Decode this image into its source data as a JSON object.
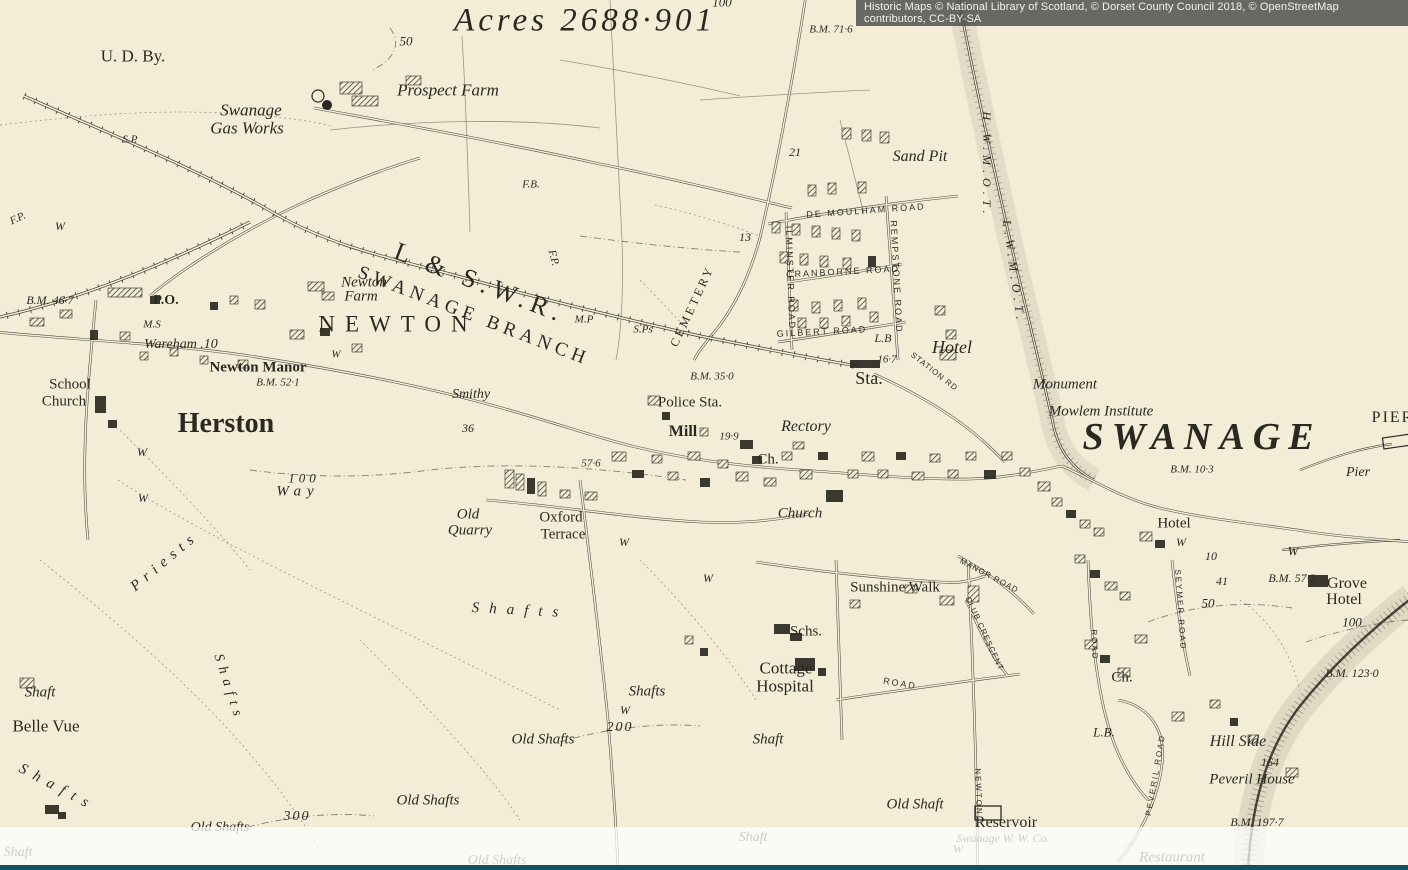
{
  "attribution": {
    "text": "Historic Maps © National Library of Scotland, © Dorset County Council 2018, © OpenStreetMap contributors, CC-BY-SA"
  },
  "colors": {
    "paper": "#f3edd7",
    "ink": "#2b2822",
    "attribution_bg": "#4a4a4a",
    "footer_bar": "#14505f"
  },
  "map": {
    "place": "Swanage",
    "labels": [
      {
        "t": "Acres 2688·901",
        "x": 585,
        "y": 21,
        "fs": 33,
        "cls": "it",
        "ls": 4
      },
      {
        "t": "100",
        "x": 722,
        "y": 2,
        "fs": 13,
        "cls": "it"
      },
      {
        "t": "B.M. 71·6",
        "x": 831,
        "y": 30,
        "fs": 11,
        "cls": "it"
      },
      {
        "t": "50",
        "x": 406,
        "y": 41,
        "fs": 13,
        "cls": "it"
      },
      {
        "t": "U. D. By.",
        "x": 133,
        "y": 56,
        "fs": 17,
        "cls": "rm"
      },
      {
        "t": "Prospect Farm",
        "x": 448,
        "y": 90,
        "fs": 17,
        "cls": "it"
      },
      {
        "t": "Swanage",
        "x": 251,
        "y": 110,
        "fs": 17,
        "cls": "it"
      },
      {
        "t": "Gas Works",
        "x": 247,
        "y": 128,
        "fs": 17,
        "cls": "it"
      },
      {
        "t": "S.P",
        "x": 130,
        "y": 140,
        "fs": 11,
        "cls": "it"
      },
      {
        "t": "21",
        "x": 795,
        "y": 152,
        "fs": 12,
        "cls": "it"
      },
      {
        "t": "Sand Pit",
        "x": 920,
        "y": 157,
        "fs": 16,
        "cls": "it"
      },
      {
        "t": "H.W.M.O.T.",
        "x": 987,
        "y": 165,
        "fs": 12,
        "cls": "it",
        "rot": 90,
        "ls": 5
      },
      {
        "t": "L.W.M.O.T.",
        "x": 1014,
        "y": 272,
        "fs": 12,
        "cls": "it",
        "rot": 82,
        "ls": 5
      },
      {
        "t": "F.B.",
        "x": 531,
        "y": 185,
        "fs": 11,
        "cls": "it"
      },
      {
        "t": "F.P.",
        "x": 18,
        "y": 219,
        "fs": 11,
        "cls": "it",
        "rot": -25
      },
      {
        "t": "W",
        "x": 60,
        "y": 226,
        "fs": 12,
        "cls": "it"
      },
      {
        "t": "13",
        "x": 745,
        "y": 237,
        "fs": 12,
        "cls": "it"
      },
      {
        "t": "F.P.",
        "x": 553,
        "y": 258,
        "fs": 11,
        "cls": "it",
        "rot": 75
      },
      {
        "t": "DE MOULHAM ROAD",
        "x": 866,
        "y": 211,
        "fs": 9,
        "cls": "sans",
        "ls": 2,
        "rot": -4
      },
      {
        "t": "CRANBORNE ROAD",
        "x": 843,
        "y": 272,
        "fs": 9,
        "cls": "sans",
        "ls": 2,
        "rot": -3
      },
      {
        "t": "GILBERT ROAD",
        "x": 822,
        "y": 332,
        "fs": 9,
        "cls": "sans",
        "ls": 2,
        "rot": -3
      },
      {
        "t": "REMPSTONE ROAD",
        "x": 896,
        "y": 277,
        "fs": 9,
        "cls": "sans",
        "ls": 2,
        "rot": 87
      },
      {
        "t": "ILMINSTER ROAD",
        "x": 790,
        "y": 278,
        "fs": 9,
        "cls": "sans",
        "ls": 2,
        "rot": 88
      },
      {
        "t": "L & S.W.R.",
        "x": 480,
        "y": 283,
        "fs": 26,
        "cls": "rm",
        "ls": 6,
        "rot": 21
      },
      {
        "t": "SWANAGE BRANCH",
        "x": 474,
        "y": 316,
        "fs": 19,
        "cls": "rm",
        "ls": 5,
        "rot": 21
      },
      {
        "t": "B.M. 46·7",
        "x": 50,
        "y": 300,
        "fs": 12,
        "cls": "it"
      },
      {
        "t": "P.O.",
        "x": 166,
        "y": 301,
        "fs": 14,
        "cls": "rm bold"
      },
      {
        "t": "Newton",
        "x": 364,
        "y": 283,
        "fs": 15,
        "cls": "it"
      },
      {
        "t": "Farm",
        "x": 361,
        "y": 297,
        "fs": 15,
        "cls": "it"
      },
      {
        "t": "NEWTON",
        "x": 398,
        "y": 324,
        "fs": 23,
        "cls": "rm",
        "ls": 10
      },
      {
        "t": "M.P",
        "x": 584,
        "y": 320,
        "fs": 11,
        "cls": "it"
      },
      {
        "t": "S.Ps",
        "x": 643,
        "y": 330,
        "fs": 11,
        "cls": "it"
      },
      {
        "t": "CEMETERY",
        "x": 692,
        "y": 306,
        "fs": 12,
        "cls": "rm",
        "ls": 3,
        "rot": -65
      },
      {
        "t": "L.B",
        "x": 883,
        "y": 338,
        "fs": 12,
        "cls": "it"
      },
      {
        "t": "Hotel",
        "x": 952,
        "y": 347,
        "fs": 18,
        "cls": "it"
      },
      {
        "t": "16·7",
        "x": 887,
        "y": 360,
        "fs": 11,
        "cls": "it"
      },
      {
        "t": "Sta.",
        "x": 869,
        "y": 378,
        "fs": 18,
        "cls": "rm"
      },
      {
        "t": "STATION RD",
        "x": 934,
        "y": 372,
        "fs": 8,
        "cls": "sans",
        "ls": 1,
        "rot": 38
      },
      {
        "t": "M.S",
        "x": 152,
        "y": 325,
        "fs": 11,
        "cls": "it"
      },
      {
        "t": "Wareham .10",
        "x": 181,
        "y": 345,
        "fs": 14,
        "cls": "it"
      },
      {
        "t": "Newton Manor",
        "x": 258,
        "y": 368,
        "fs": 15,
        "cls": "rm bold"
      },
      {
        "t": "B.M. 52·1",
        "x": 278,
        "y": 383,
        "fs": 11,
        "cls": "it"
      },
      {
        "t": "W",
        "x": 336,
        "y": 355,
        "fs": 11,
        "cls": "it"
      },
      {
        "t": "School",
        "x": 70,
        "y": 385,
        "fs": 15,
        "cls": "rm"
      },
      {
        "t": "Church",
        "x": 64,
        "y": 402,
        "fs": 15,
        "cls": "rm"
      },
      {
        "t": "Herston",
        "x": 226,
        "y": 424,
        "fs": 28,
        "cls": "rm bold"
      },
      {
        "t": "Smithy",
        "x": 471,
        "y": 395,
        "fs": 14,
        "cls": "it"
      },
      {
        "t": "36",
        "x": 468,
        "y": 428,
        "fs": 12,
        "cls": "it"
      },
      {
        "t": "B.M. 35·0",
        "x": 712,
        "y": 377,
        "fs": 11,
        "cls": "it"
      },
      {
        "t": "Police Sta.",
        "x": 690,
        "y": 403,
        "fs": 15,
        "cls": "rm"
      },
      {
        "t": "Mill",
        "x": 683,
        "y": 432,
        "fs": 16,
        "cls": "rm bold"
      },
      {
        "t": "19·9",
        "x": 729,
        "y": 437,
        "fs": 11,
        "cls": "it"
      },
      {
        "t": "Rectory",
        "x": 806,
        "y": 427,
        "fs": 16,
        "cls": "it"
      },
      {
        "t": "Ch.",
        "x": 768,
        "y": 460,
        "fs": 15,
        "cls": "rm"
      },
      {
        "t": "Monument",
        "x": 1065,
        "y": 385,
        "fs": 15,
        "cls": "it"
      },
      {
        "t": "Mowlem Institute",
        "x": 1101,
        "y": 412,
        "fs": 15,
        "cls": "it"
      },
      {
        "t": "SWANAGE",
        "x": 1202,
        "y": 437,
        "fs": 38,
        "cls": "it bold",
        "ls": 8
      },
      {
        "t": "B.M. 10·3",
        "x": 1192,
        "y": 470,
        "fs": 11,
        "cls": "it"
      },
      {
        "t": "PIER",
        "x": 1393,
        "y": 418,
        "fs": 16,
        "cls": "rm",
        "ls": 2
      },
      {
        "t": "Pier",
        "x": 1358,
        "y": 473,
        "fs": 14,
        "cls": "it"
      },
      {
        "t": "57·6",
        "x": 591,
        "y": 464,
        "fs": 11,
        "cls": "it"
      },
      {
        "t": "100",
        "x": 304,
        "y": 478,
        "fs": 13,
        "cls": "it",
        "ls": 4
      },
      {
        "t": "Way",
        "x": 298,
        "y": 492,
        "fs": 15,
        "cls": "it",
        "ls": 6
      },
      {
        "t": "Priests",
        "x": 165,
        "y": 562,
        "fs": 15,
        "cls": "it",
        "ls": 6,
        "rot": -40
      },
      {
        "t": "Church",
        "x": 800,
        "y": 514,
        "fs": 15,
        "cls": "it"
      },
      {
        "t": "Old",
        "x": 468,
        "y": 515,
        "fs": 15,
        "cls": "it"
      },
      {
        "t": "Quarry",
        "x": 470,
        "y": 531,
        "fs": 15,
        "cls": "it"
      },
      {
        "t": "Oxford",
        "x": 561,
        "y": 518,
        "fs": 15,
        "cls": "rm"
      },
      {
        "t": "Terrace",
        "x": 563,
        "y": 535,
        "fs": 15,
        "cls": "rm"
      },
      {
        "t": "W",
        "x": 624,
        "y": 542,
        "fs": 12,
        "cls": "it"
      },
      {
        "t": "W",
        "x": 708,
        "y": 578,
        "fs": 12,
        "cls": "it"
      },
      {
        "t": "W",
        "x": 142,
        "y": 452,
        "fs": 12,
        "cls": "it"
      },
      {
        "t": "W",
        "x": 143,
        "y": 498,
        "fs": 12,
        "cls": "it"
      },
      {
        "t": "Hotel",
        "x": 1174,
        "y": 524,
        "fs": 15,
        "cls": "rm"
      },
      {
        "t": "W",
        "x": 1181,
        "y": 542,
        "fs": 12,
        "cls": "it"
      },
      {
        "t": "W",
        "x": 1293,
        "y": 551,
        "fs": 13,
        "cls": "it"
      },
      {
        "t": "10",
        "x": 1211,
        "y": 556,
        "fs": 12,
        "cls": "it"
      },
      {
        "t": "41",
        "x": 1222,
        "y": 581,
        "fs": 12,
        "cls": "it"
      },
      {
        "t": "B.M. 57·2",
        "x": 1292,
        "y": 578,
        "fs": 12,
        "cls": "it"
      },
      {
        "t": "Grove",
        "x": 1347,
        "y": 584,
        "fs": 16,
        "cls": "rm"
      },
      {
        "t": "Hotel",
        "x": 1344,
        "y": 600,
        "fs": 16,
        "cls": "rm"
      },
      {
        "t": "50",
        "x": 1208,
        "y": 603,
        "fs": 13,
        "cls": "it"
      },
      {
        "t": "SEYMER ROAD",
        "x": 1180,
        "y": 610,
        "fs": 8,
        "cls": "sans",
        "ls": 2,
        "rot": 86
      },
      {
        "t": "Sunshine Walk",
        "x": 895,
        "y": 588,
        "fs": 15,
        "cls": "rm"
      },
      {
        "t": "MANOR ROAD",
        "x": 989,
        "y": 576,
        "fs": 8,
        "cls": "sans",
        "ls": 1,
        "rot": 28
      },
      {
        "t": "CLUB CRESCENT",
        "x": 984,
        "y": 634,
        "fs": 8,
        "cls": "sans",
        "ls": 1,
        "rot": 65
      },
      {
        "t": "ROAD",
        "x": 1094,
        "y": 645,
        "fs": 8,
        "cls": "sans",
        "ls": 2,
        "rot": 88
      },
      {
        "t": "Schs.",
        "x": 806,
        "y": 632,
        "fs": 15,
        "cls": "rm"
      },
      {
        "t": "Cottage",
        "x": 786,
        "y": 668,
        "fs": 17,
        "cls": "rm"
      },
      {
        "t": "Hospital",
        "x": 785,
        "y": 686,
        "fs": 17,
        "cls": "rm"
      },
      {
        "t": "ROAD",
        "x": 900,
        "y": 684,
        "fs": 9,
        "cls": "sans",
        "ls": 2,
        "rot": 10
      },
      {
        "t": "NEWTON",
        "x": 978,
        "y": 792,
        "fs": 8,
        "cls": "sans",
        "ls": 2,
        "rot": 88
      },
      {
        "t": "PEVERIL ROAD",
        "x": 1156,
        "y": 775,
        "fs": 8,
        "cls": "sans",
        "ls": 2,
        "rot": -80
      },
      {
        "t": "Shafts",
        "x": 520,
        "y": 611,
        "fs": 15,
        "cls": "it",
        "ls": 10,
        "rot": 3
      },
      {
        "t": "Shafts",
        "x": 647,
        "y": 692,
        "fs": 15,
        "cls": "it"
      },
      {
        "t": "W",
        "x": 625,
        "y": 710,
        "fs": 12,
        "cls": "it"
      },
      {
        "t": "200",
        "x": 620,
        "y": 728,
        "fs": 14,
        "cls": "it",
        "ls": 2
      },
      {
        "t": "Old Shafts",
        "x": 543,
        "y": 740,
        "fs": 15,
        "cls": "it"
      },
      {
        "t": "Shaft",
        "x": 768,
        "y": 740,
        "fs": 15,
        "cls": "it"
      },
      {
        "t": "Old Shafts",
        "x": 428,
        "y": 801,
        "fs": 15,
        "cls": "it"
      },
      {
        "t": "300",
        "x": 297,
        "y": 817,
        "fs": 14,
        "cls": "it",
        "ls": 2
      },
      {
        "t": "Old Shafts",
        "x": 220,
        "y": 828,
        "fs": 14,
        "cls": "it"
      },
      {
        "t": "Shaft",
        "x": 40,
        "y": 693,
        "fs": 15,
        "cls": "it"
      },
      {
        "t": "Belle Vue",
        "x": 46,
        "y": 726,
        "fs": 17,
        "cls": "rm"
      },
      {
        "t": "Shafts",
        "x": 57,
        "y": 788,
        "fs": 15,
        "cls": "it",
        "ls": 8,
        "rot": 28
      },
      {
        "t": "Shafts",
        "x": 228,
        "y": 688,
        "fs": 14,
        "cls": "it",
        "ls": 6,
        "rot": 72
      },
      {
        "t": "Old Shaft",
        "x": 915,
        "y": 805,
        "fs": 15,
        "cls": "it"
      },
      {
        "t": "Reservoir",
        "x": 1006,
        "y": 823,
        "fs": 16,
        "cls": "rm"
      },
      {
        "t": "Swanage W. W. Co.",
        "x": 1003,
        "y": 838,
        "fs": 12,
        "cls": "it",
        "op": 0.85
      },
      {
        "t": "W",
        "x": 958,
        "y": 849,
        "fs": 12,
        "cls": "it",
        "op": 0.85
      },
      {
        "t": "Restaurant",
        "x": 1172,
        "y": 858,
        "fs": 15,
        "cls": "it",
        "op": 0.85
      },
      {
        "t": "Ch.",
        "x": 1122,
        "y": 678,
        "fs": 15,
        "cls": "rm"
      },
      {
        "t": "B.M. 123·0",
        "x": 1352,
        "y": 673,
        "fs": 12,
        "cls": "it"
      },
      {
        "t": "L.B.",
        "x": 1104,
        "y": 732,
        "fs": 13,
        "cls": "it"
      },
      {
        "t": "Hill Side",
        "x": 1238,
        "y": 742,
        "fs": 16,
        "cls": "it"
      },
      {
        "t": "164",
        "x": 1270,
        "y": 762,
        "fs": 12,
        "cls": "it"
      },
      {
        "t": "Peveril House",
        "x": 1252,
        "y": 780,
        "fs": 15,
        "cls": "it"
      },
      {
        "t": "B.M. 197·7",
        "x": 1257,
        "y": 822,
        "fs": 12,
        "cls": "it"
      },
      {
        "t": "100",
        "x": 1352,
        "y": 622,
        "fs": 13,
        "cls": "it"
      },
      {
        "t": "Shaft",
        "x": 18,
        "y": 853,
        "fs": 14,
        "cls": "it",
        "op": 0.8
      },
      {
        "t": "Old Shafts",
        "x": 497,
        "y": 861,
        "fs": 14,
        "cls": "it",
        "op": 0.8
      },
      {
        "t": "Shaft",
        "x": 753,
        "y": 838,
        "fs": 14,
        "cls": "it",
        "op": 0.85
      }
    ]
  }
}
